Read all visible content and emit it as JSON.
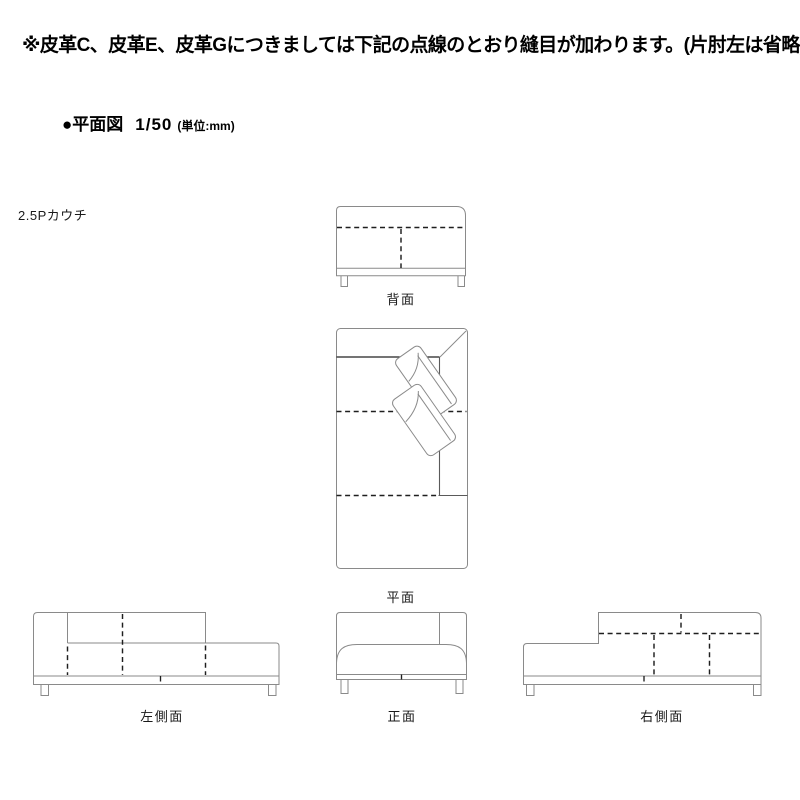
{
  "note": "※皮革C、皮革E、皮革Gにつきましては下記の点線のとおり縫目が加わります。(片肘左は省略)",
  "heading": {
    "bullet": "●",
    "title": "平面図",
    "scale": "1/50",
    "unit": "(単位:mm)"
  },
  "product_label": "2.5Pカウチ",
  "views": {
    "back": {
      "label": "背面"
    },
    "plan": {
      "label": "平面"
    },
    "left_side": {
      "label": "左側面"
    },
    "front": {
      "label": "正面"
    },
    "right_side": {
      "label": "右側面"
    }
  },
  "legend": {
    "outline_color": "#8a8a8a",
    "seam_color": "#1f1f1f",
    "text_color": "#000000",
    "background_color": "#ffffff"
  }
}
